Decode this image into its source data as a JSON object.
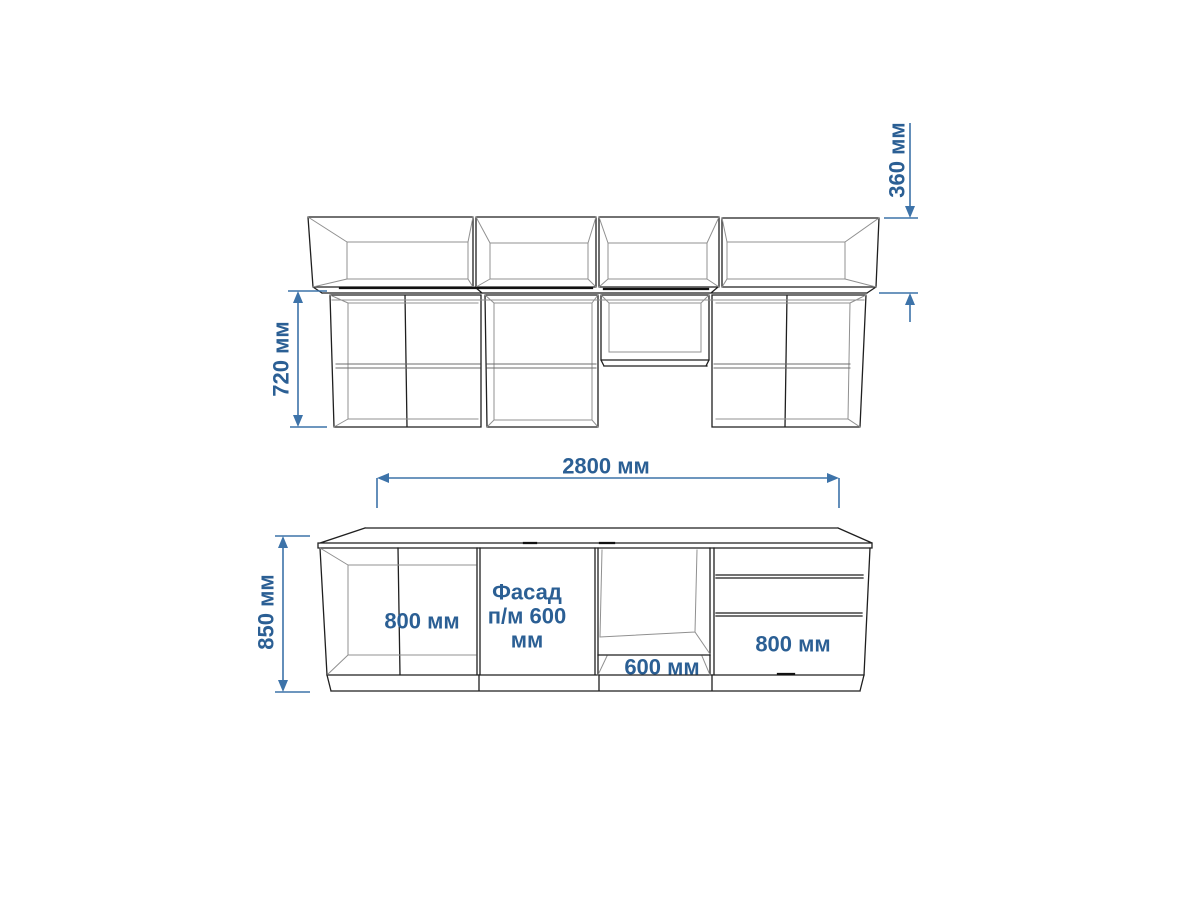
{
  "document": {
    "background": "#ffffff",
    "type": "kitchen-cabinet-elevation-drawing"
  },
  "colors": {
    "label_text": "#2b5f94",
    "dimension": "#3d73a9",
    "outline_dark": "#1f1f1f",
    "outline_light": "#909090"
  },
  "upper_view": {
    "top_box_height": "360 мм",
    "cabinet_height": "720 мм",
    "top_row_box_count": 4,
    "bottom_row_cabinet_count": 4
  },
  "base_view": {
    "total_width": "2800 мм",
    "total_height": "850 мм",
    "sections": [
      {
        "type": "two-door-cabinet",
        "label": "800 мм"
      },
      {
        "type": "dishwasher-facade",
        "label": "Фасад п/м 600 мм",
        "lines": [
          "Фасад",
          "п/м 600",
          "мм"
        ]
      },
      {
        "type": "oven-niche",
        "label": "600 мм"
      },
      {
        "type": "drawer-cabinet",
        "label": "800 мм"
      }
    ]
  }
}
